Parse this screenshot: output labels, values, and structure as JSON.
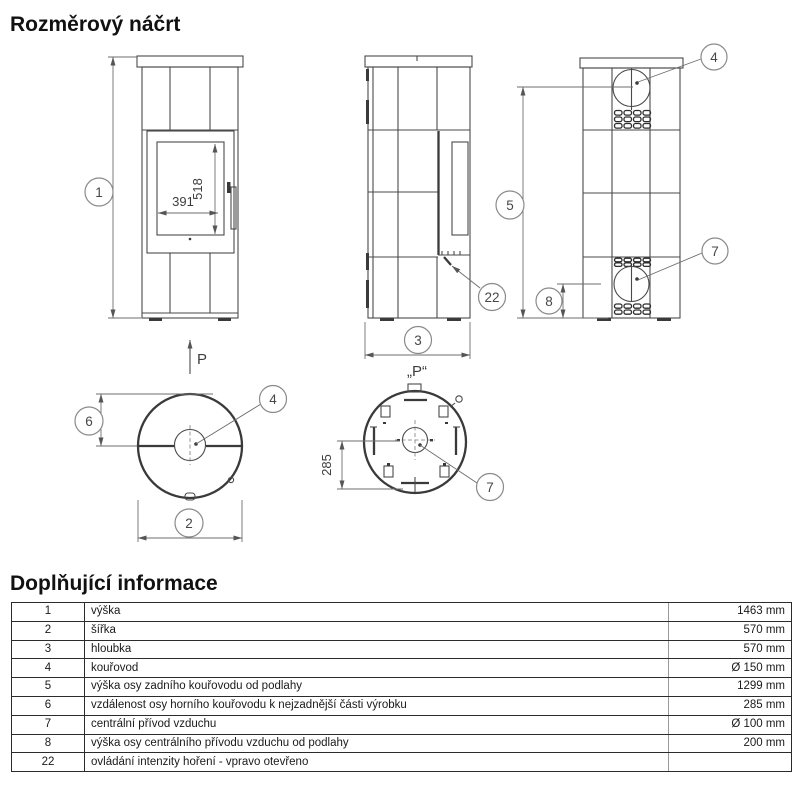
{
  "page": {
    "drawing_title": "Rozměrový náčrt",
    "info_title": "Doplňující informace"
  },
  "drawing": {
    "callouts": {
      "c1": "1",
      "c2": "2",
      "c3": "3",
      "c4": "4",
      "c5": "5",
      "c6": "6",
      "c7": "7",
      "c8": "8",
      "c22": "22"
    },
    "dims": {
      "glass_height": "518",
      "glass_width": "391",
      "air_axis_offset": "285"
    },
    "labels": {
      "arrow_p": "P",
      "view_p": "„P“"
    }
  },
  "table": {
    "rows": [
      {
        "num": "1",
        "desc": "výška",
        "value": "1463 mm"
      },
      {
        "num": "2",
        "desc": "šířka",
        "value": "570 mm"
      },
      {
        "num": "3",
        "desc": "hloubka",
        "value": "570 mm"
      },
      {
        "num": "4",
        "desc": "kouřovod",
        "value": "Ø 150 mm"
      },
      {
        "num": "5",
        "desc": "výška osy zadního kouřovodu od podlahy",
        "value": "1299 mm"
      },
      {
        "num": "6",
        "desc": "vzdálenost osy horního kouřovodu k nejzadnější části výrobku",
        "value": "285 mm"
      },
      {
        "num": "7",
        "desc": "centrální přívod vzduchu",
        "value": "Ø 100 mm"
      },
      {
        "num": "8",
        "desc": "výška osy centrálního přívodu vzduchu od podlahy",
        "value": "200 mm"
      },
      {
        "num": "22",
        "desc": "ovládání intenzity hoření - vpravo otevřeno",
        "value": ""
      }
    ]
  }
}
